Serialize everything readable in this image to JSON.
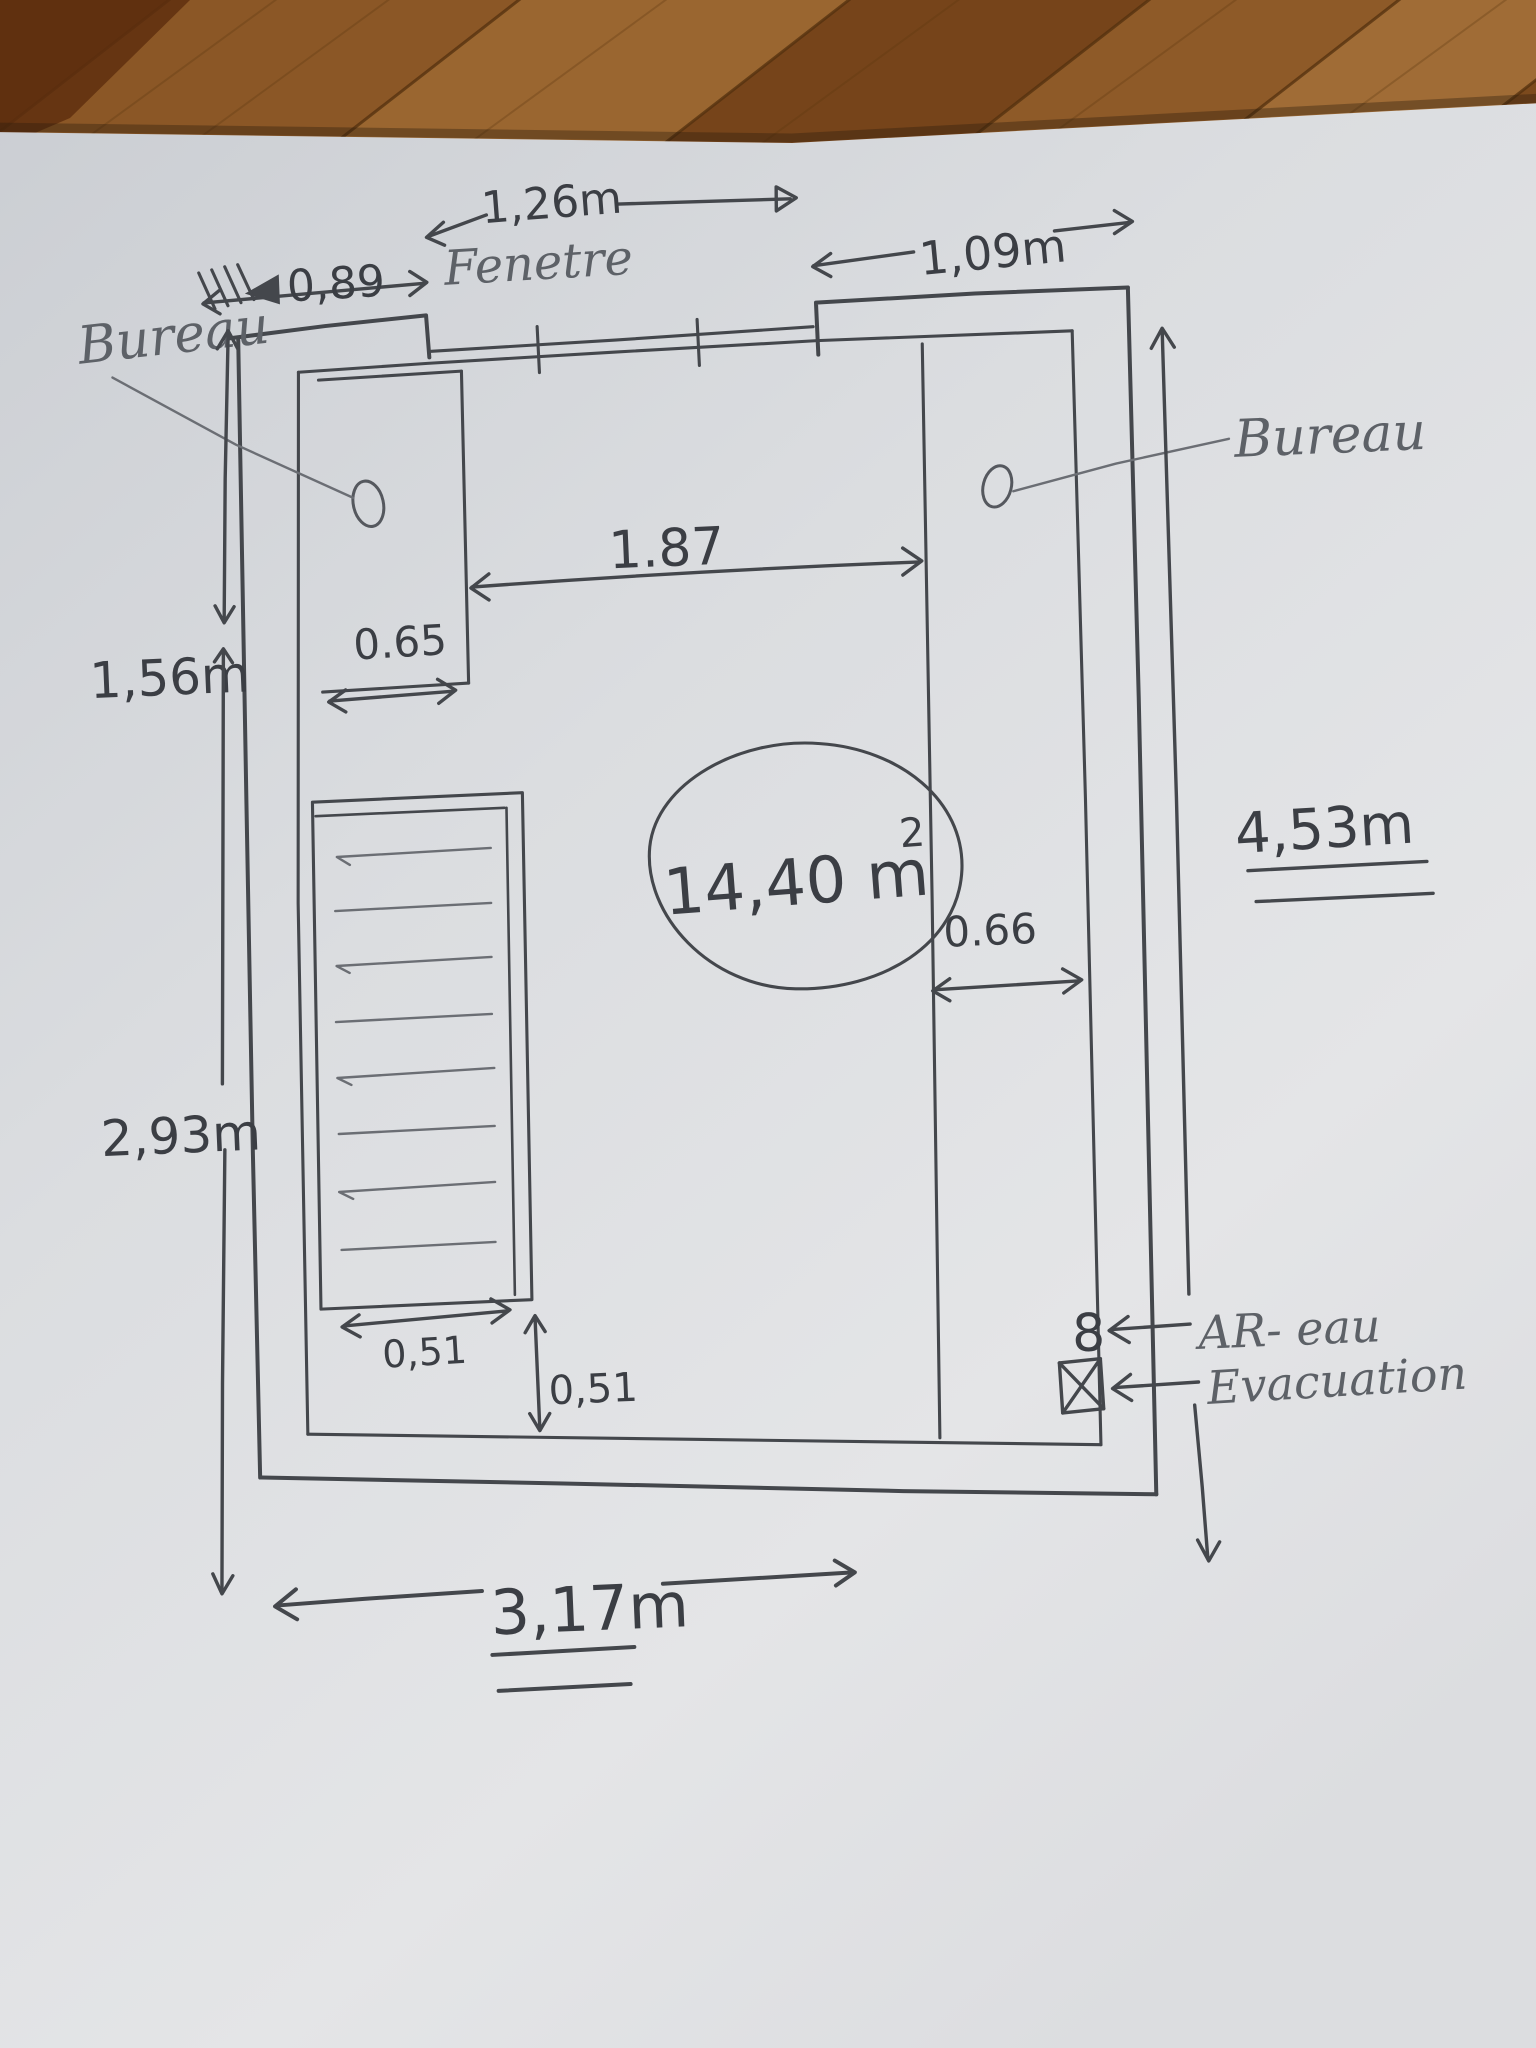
{
  "labels": {
    "window": "Fenetre",
    "desk_left": "Bureau",
    "desk_right": "Bureau",
    "water_supply": "AR- eau",
    "water_supply_symbol": "8",
    "drain": "Evacuation",
    "area_value": "14,40 m",
    "area_exponent": "2"
  },
  "dimensions": {
    "window_width": "1,26m",
    "left_of_window": "0,89",
    "right_of_window": "1,09m",
    "between_desks": "1.87",
    "left_desk_width": "0.65",
    "right_desk_width": "0.66",
    "upper_left_height": "1,56m",
    "lower_left_height": "2,93m",
    "total_height": "4,53m",
    "radiator_width": "0,51",
    "below_radiator": "0,51",
    "total_width": "3,17m"
  },
  "colors": {
    "ink": "#44474c",
    "pencil": "#6b6e74",
    "paper": "#dcdee1",
    "wood": "#8a5527"
  }
}
